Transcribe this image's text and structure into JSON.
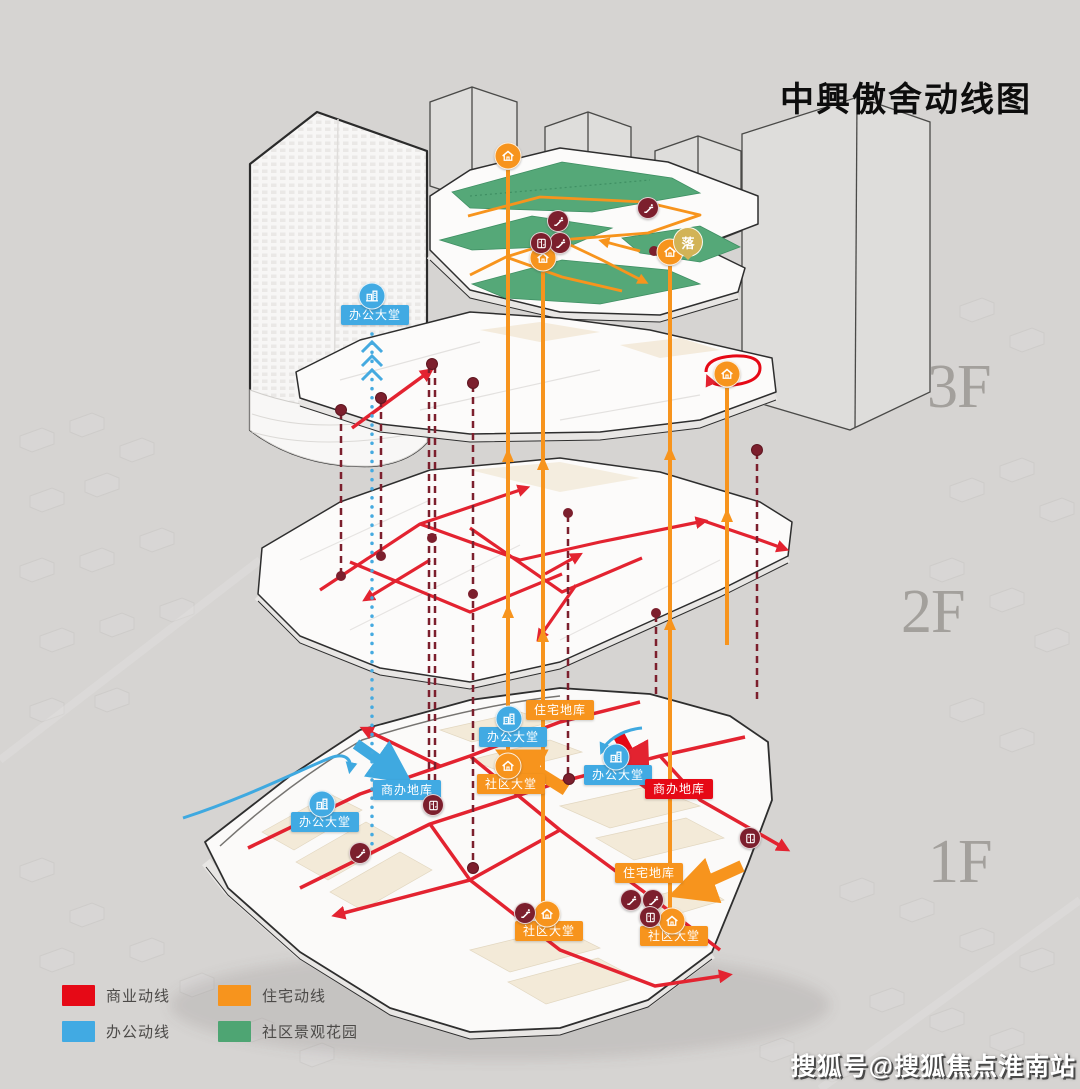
{
  "title": "中興傲舍动线图",
  "floor_labels": [
    "3F",
    "2F",
    "1F"
  ],
  "legend": {
    "items": [
      {
        "label": "商业动线",
        "color": "#e60916"
      },
      {
        "label": "住宅动线",
        "color": "#f7941d"
      },
      {
        "label": "办公动线",
        "color": "#41aae3"
      },
      {
        "label": "社区景观花园",
        "color": "#4ea573"
      }
    ]
  },
  "map_labels": {
    "tower_office_lobby": "办公大堂",
    "office_lobby_west": "办公大堂",
    "office_garage_west": "商办地库",
    "office_lobby_mid": "办公大堂",
    "residential_garage_mid": "住宅地库",
    "community_lobby_mid": "社区大堂",
    "office_lobby_east": "办公大堂",
    "office_garage_east": "商办地库",
    "residential_garage_south": "住宅地库",
    "community_lobby_southwest": "社区大堂",
    "community_lobby_southeast": "社区大堂",
    "dropoff_badge": "落"
  },
  "icons": {
    "office-lobby-icon": "white building glyph in blue circle",
    "entrance-icon": "white house glyph in orange circle",
    "escalator-icon": "white escalator glyph in dark-red circle",
    "elevator-icon": "white elevator-doors glyph in dark-red circle",
    "dropoff-badge": "gold circle badge with character"
  },
  "colors": {
    "commercial": "#e60916",
    "residential": "#f7941d",
    "office": "#41aae3",
    "garden": "#4ea573",
    "transport_node": "#7c1f2d",
    "drop_off": "#d2b356",
    "background": "#d6d4d2"
  },
  "watermark": "搜狐号@搜狐焦点淮南站"
}
